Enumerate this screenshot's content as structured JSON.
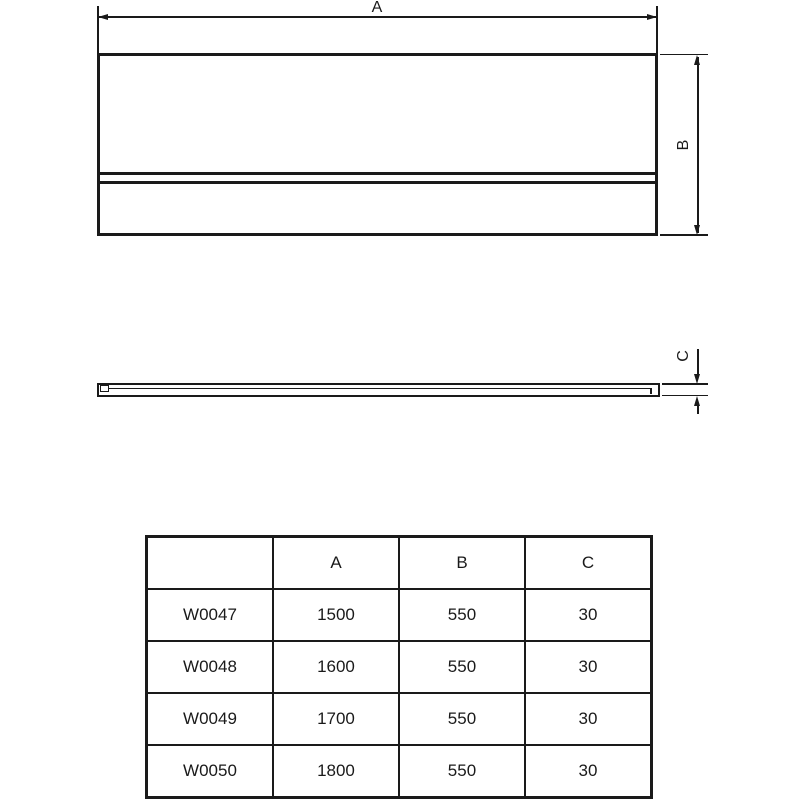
{
  "drawing": {
    "front_view": {
      "width_dim_label": "A",
      "height_dim_label": "B"
    },
    "side_view": {
      "thickness_dim_label": "C"
    }
  },
  "table": {
    "headers": [
      "",
      "A",
      "B",
      "C"
    ],
    "rows": [
      {
        "code": "W0047",
        "a": "1500",
        "b": "550",
        "c": "30"
      },
      {
        "code": "W0048",
        "a": "1600",
        "b": "550",
        "c": "30"
      },
      {
        "code": "W0049",
        "a": "1700",
        "b": "550",
        "c": "30"
      },
      {
        "code": "W0050",
        "a": "1800",
        "b": "550",
        "c": "30"
      }
    ]
  },
  "colors": {
    "line": "#1a1a1a",
    "background": "#ffffff"
  }
}
